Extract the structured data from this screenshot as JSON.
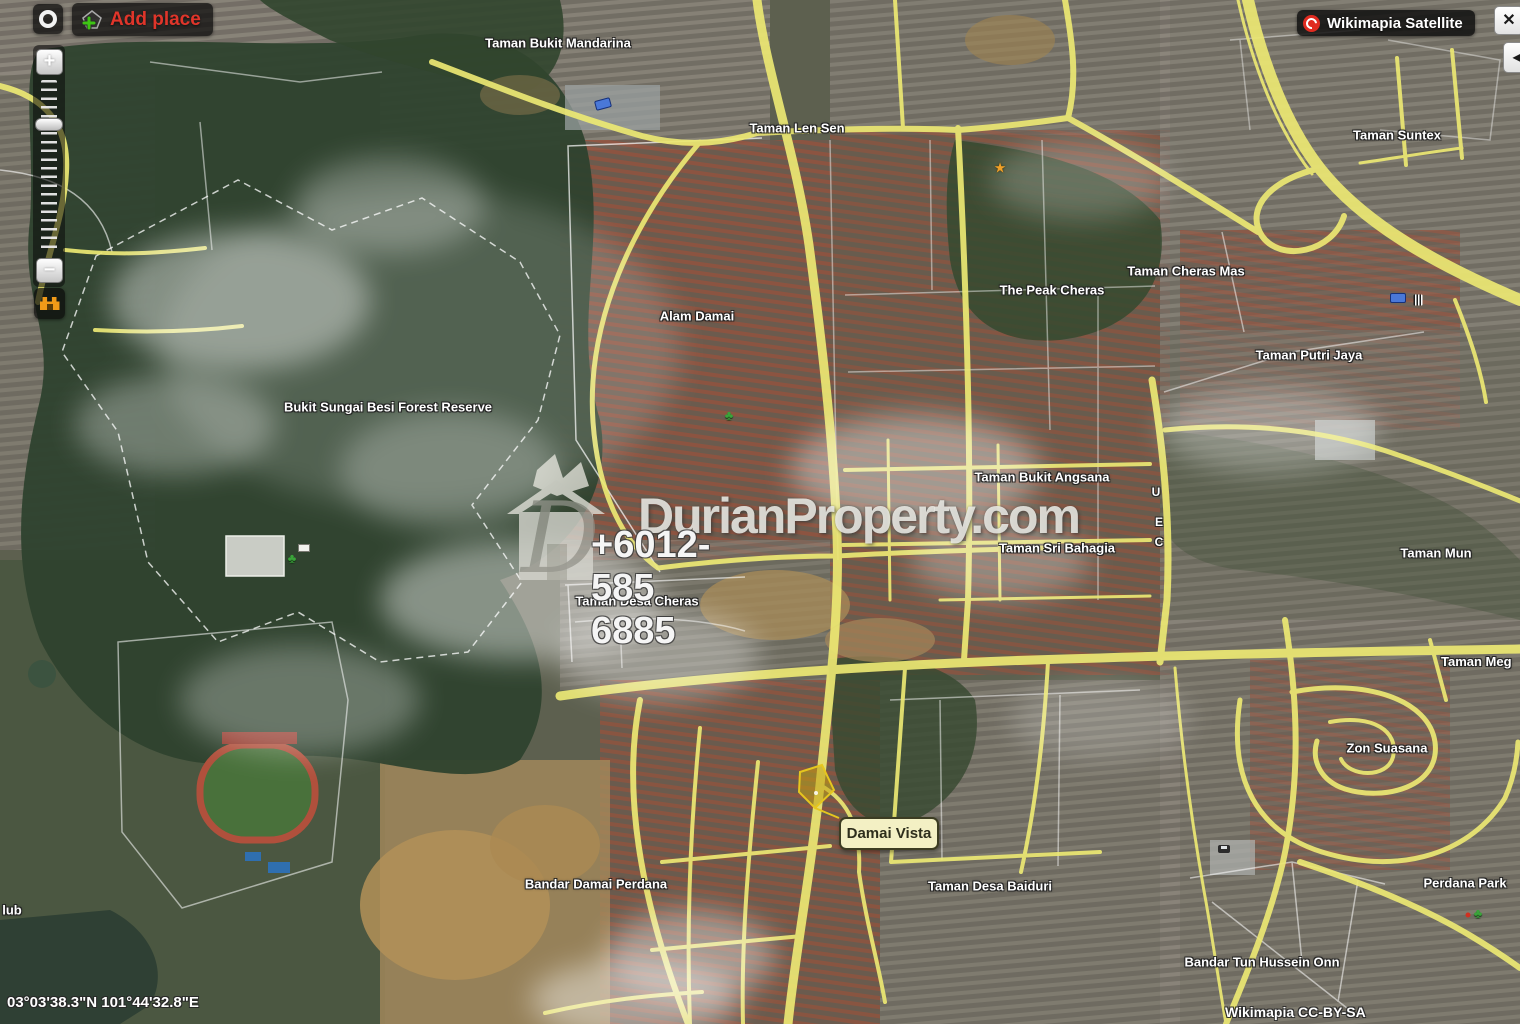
{
  "controls": {
    "add_place_label": "Add place",
    "map_type_label": "Wikimapia Satellite",
    "close_label": "✕",
    "collapse_label": "◀",
    "zoom_in_label": "+",
    "zoom_out_label": "−"
  },
  "watermark": {
    "logo_letter": "D",
    "brand": "DurianProperty.com",
    "phone": "+6012-585 6885"
  },
  "tooltip": {
    "label": "Damai Vista"
  },
  "status": {
    "coordinates": "03°03'38.3\"N 101°44'32.8\"E"
  },
  "attribution": "Wikimapia CC-BY-SA",
  "road_letters": {
    "u": "U",
    "e": "E",
    "c": "C"
  },
  "labels": [
    {
      "text": "Taman Bukit Mandarina"
    },
    {
      "text": "Taman Len Sen"
    },
    {
      "text": "Taman Suntex"
    },
    {
      "text": "The Peak Cheras"
    },
    {
      "text": "Taman Cheras Mas"
    },
    {
      "text": "Taman Putri Jaya"
    },
    {
      "text": "Alam Damai"
    },
    {
      "text": "Bukit Sungai Besi Forest Reserve"
    },
    {
      "text": "Taman Bukit Angsana"
    },
    {
      "text": "Taman Sri Bahagia"
    },
    {
      "text": "Taman Mun"
    },
    {
      "text": "Taman Desa Cheras"
    },
    {
      "text": "Taman Meg"
    },
    {
      "text": "Zon Suasana"
    },
    {
      "text": "Bandar Damai Perdana"
    },
    {
      "text": "Taman Desa Baiduri"
    },
    {
      "text": "Perdana Park"
    },
    {
      "text": "Bandar Tun Hussein Onn"
    },
    {
      "text": "lub"
    }
  ],
  "colors": {
    "road_yellow": "#ece873",
    "selection_yellow": "#e6c61e",
    "add_place_red": "#e0352a",
    "tooltip_bg": "#f3f0c4",
    "wikimapia_red": "#e02b20"
  }
}
